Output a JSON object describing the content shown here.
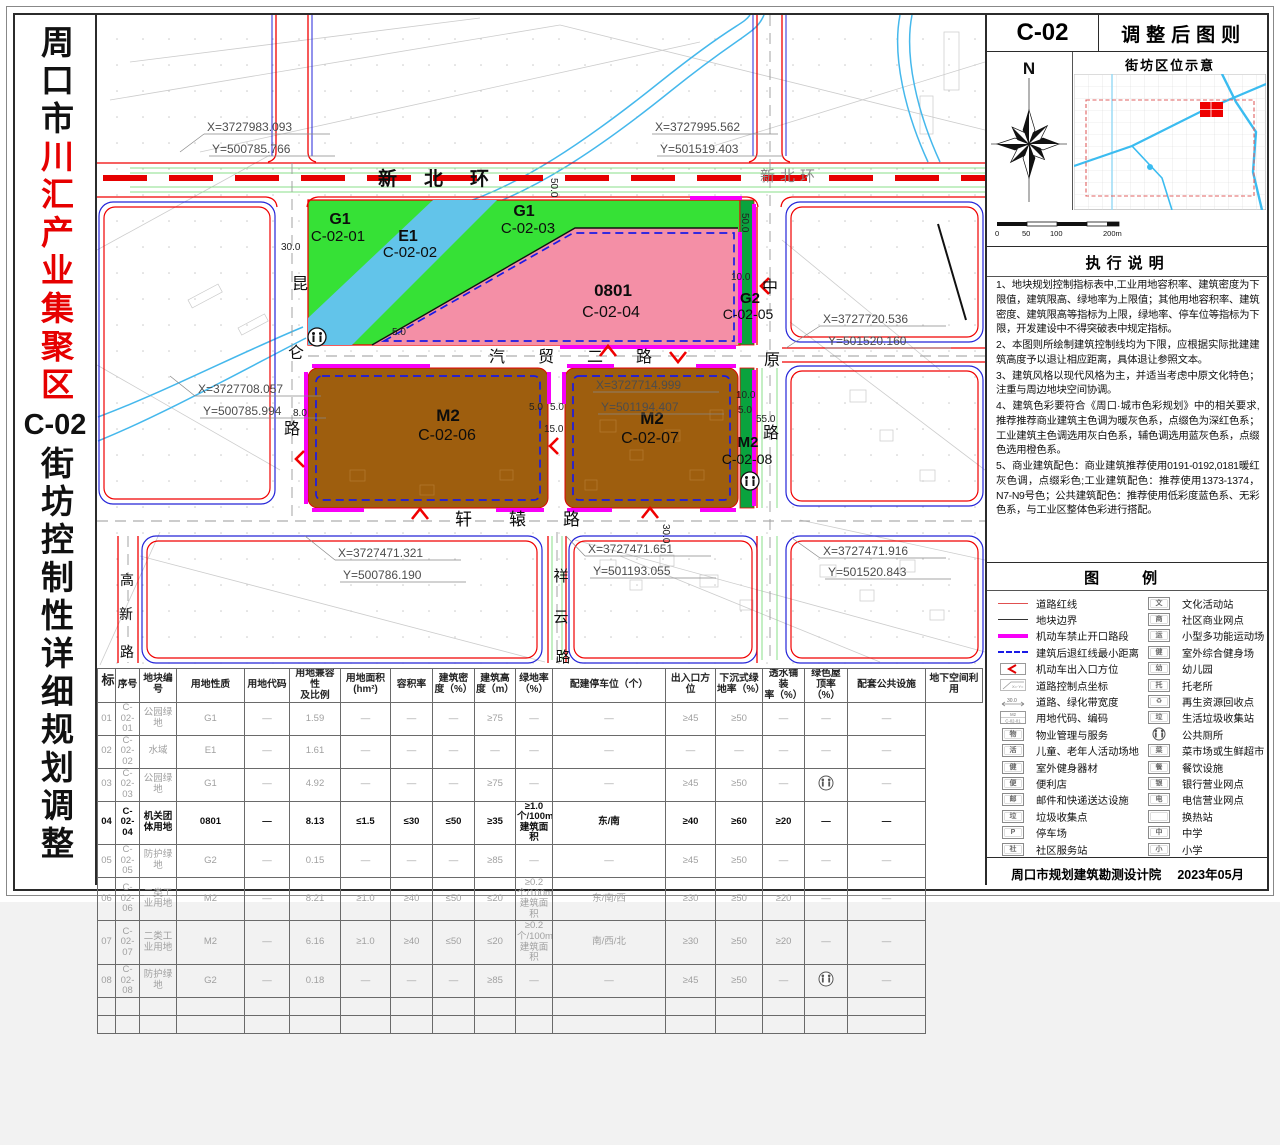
{
  "title": {
    "part1": "周口市",
    "highlight": "川汇产业集聚区",
    "code": "C-02",
    "part2": "街坊控制性详细规划调整"
  },
  "header": {
    "block_code": "C-02",
    "sheet_title": "调整后图则",
    "location_title": "街坊区位示意",
    "north_label": "N",
    "scale_labels": [
      "0",
      "50",
      "100",
      "200m"
    ]
  },
  "notes": {
    "title": "执行说明",
    "items": [
      "1、地块规划控制指标表中,工业用地容积率、建筑密度为下限值，建筑限高、绿地率为上限值；其他用地容积率、建筑密度、建筑限高等指标为上限，绿地率、停车位等指标为下限，开发建设中不得突破表中规定指标。",
      "2、本图则所绘制建筑控制线均为下限，应根据实际批建建筑高度予以退让相应距离，具体退让参照文本。",
      "3、建筑风格以现代风格为主，并适当考虑中原文化特色；注重与周边地块空间协调。",
      "4、建筑色彩要符合《周口·城市色彩规划》中的相关要求,推荐推荐商业建筑主色调为暖灰色系，点缀色为深红色系；工业建筑主色调选用灰白色系，辅色调选用蓝灰色系，点缀色选用橙色系。",
      "5、商业建筑配色：商业建筑推荐使用0191-0192,0181暖红灰色调，点缀彩色;工业建筑配色：推荐使用1373-1374，N7-N9号色；公共建筑配色：推荐使用低彩度蓝色系、无彩色系，与工业区整体色彩进行搭配。"
    ]
  },
  "legend": {
    "title": "图　例",
    "left": [
      {
        "sym": "line",
        "color": "#e05050",
        "label": "道路红线"
      },
      {
        "sym": "line",
        "color": "#333333",
        "label": "地块边界"
      },
      {
        "sym": "thick",
        "color": "#f800f8",
        "label": "机动车禁止开口路段"
      },
      {
        "sym": "dash",
        "color": "#1a1ae6",
        "label": "建筑后退红线最小距离"
      },
      {
        "sym": "arrow",
        "label": "机动车出入口方位"
      },
      {
        "sym": "coord",
        "symtext": "X=·Y=",
        "label": "道路控制点坐标"
      },
      {
        "sym": "width",
        "symtext": "30.0",
        "label": "道路、绿化带宽度"
      },
      {
        "sym": "code",
        "symtext": "M2|C-02-01",
        "label": "用地代码、编码"
      },
      {
        "sym": "box",
        "glyph": "物",
        "label": "物业管理与服务"
      },
      {
        "sym": "box",
        "glyph": "活",
        "label": "儿童、老年人活动场地"
      },
      {
        "sym": "box",
        "glyph": "健",
        "label": "室外健身器材"
      },
      {
        "sym": "box",
        "glyph": "便",
        "label": "便利店"
      },
      {
        "sym": "box",
        "glyph": "邮",
        "label": "邮件和快递送达设施"
      },
      {
        "sym": "box",
        "glyph": "垃",
        "label": "垃圾收集点"
      },
      {
        "sym": "box",
        "glyph": "P",
        "label": "停车场"
      },
      {
        "sym": "box",
        "glyph": "社",
        "label": "社区服务站"
      }
    ],
    "right": [
      {
        "sym": "box",
        "glyph": "文",
        "label": "文化活动站"
      },
      {
        "sym": "box",
        "glyph": "商",
        "label": "社区商业网点"
      },
      {
        "sym": "box",
        "glyph": "运",
        "label": "小型多功能运动场"
      },
      {
        "sym": "box",
        "glyph": "健",
        "label": "室外综合健身场"
      },
      {
        "sym": "box",
        "glyph": "幼",
        "label": "幼儿园"
      },
      {
        "sym": "box",
        "glyph": "托",
        "label": "托老所"
      },
      {
        "sym": "box",
        "glyph": "♻",
        "label": "再生资源回收点"
      },
      {
        "sym": "box",
        "glyph": "垃",
        "label": "生活垃圾收集站"
      },
      {
        "sym": "toilet",
        "label": "公共厕所"
      },
      {
        "sym": "box",
        "glyph": "菜",
        "label": "菜市场或生鲜超市"
      },
      {
        "sym": "box",
        "glyph": "餐",
        "label": "餐饮设施"
      },
      {
        "sym": "box",
        "glyph": "银",
        "label": "银行营业网点"
      },
      {
        "sym": "box",
        "glyph": "电",
        "label": "电信营业网点"
      },
      {
        "sym": "box",
        "glyph": "",
        "label": "换热站"
      },
      {
        "sym": "box",
        "glyph": "中",
        "label": "中学"
      },
      {
        "sym": "box",
        "glyph": "小",
        "label": "小学"
      }
    ]
  },
  "footer": {
    "org": "周口市规划建筑勘测设计院",
    "date": "2023年05月"
  },
  "map": {
    "road_names": {
      "xinbeihuan": "新北环",
      "xinbeihuan2": "新北环",
      "kunlun": "昆仑路",
      "zhongyuan": "中原路",
      "qimao": "汽贸二路",
      "xuanyuan": "轩辕路",
      "xiangyun": "祥云路",
      "gaoxin": "高新路"
    },
    "zones": [
      {
        "code": "G1",
        "id": "C-02-01"
      },
      {
        "code": "E1",
        "id": "C-02-02"
      },
      {
        "code": "G1",
        "id": "C-02-03"
      },
      {
        "code": "0801",
        "id": "C-02-04"
      },
      {
        "code": "G2",
        "id": "C-02-05"
      },
      {
        "code": "M2",
        "id": "C-02-06"
      },
      {
        "code": "M2",
        "id": "C-02-07"
      },
      {
        "code": "M2",
        "id": "C-02-08"
      }
    ],
    "coords": [
      {
        "x": "X=3727983.093",
        "y": "Y=500785.766"
      },
      {
        "x": "X=3727995.562",
        "y": "Y=501519.403"
      },
      {
        "x": "X=3727708.057",
        "y": "Y=500785.994"
      },
      {
        "x": "X=3727714.999",
        "y": "Y=501194.407"
      },
      {
        "x": "X=3727720.536",
        "y": "Y=501520.160"
      },
      {
        "x": "X=3727471.321",
        "y": "Y=500786.190"
      },
      {
        "x": "X=3727471.651",
        "y": "Y=501193.055"
      },
      {
        "x": "X=3727471.916",
        "y": "Y=501520.843"
      }
    ],
    "dims": [
      "50.0",
      "50.0",
      "30.0",
      "5.0",
      "8.0",
      "5.0",
      "5.0",
      "15.0",
      "10.0",
      "10.0",
      "5.0",
      "55.0",
      "30.0"
    ]
  },
  "table": {
    "row_header": "地块控制指标",
    "columns": [
      "序号",
      "地块编号",
      "用地性质",
      "用地代码",
      "用地兼容性\n及比例",
      "用地面积\n(hm²)",
      "容积率",
      "建筑密\n度（%）",
      "建筑高\n度（m）",
      "绿地率\n（%）",
      "配建停车位（个）",
      "出入口方位",
      "下沉式绿\n地率（%）",
      "透水铺装\n率（%）",
      "绿色屋\n顶率（%）",
      "配套公共设施",
      "地下空间利用"
    ],
    "rows": [
      {
        "muted": true,
        "cells": [
          "01",
          "C-02-01",
          "公园绿地",
          "G1",
          "—",
          "1.59",
          "—",
          "—",
          "—",
          "≥75",
          "—",
          "—",
          "≥45",
          "≥50",
          "—",
          "—",
          "—"
        ]
      },
      {
        "muted": true,
        "cells": [
          "02",
          "C-02-02",
          "水域",
          "E1",
          "—",
          "1.61",
          "—",
          "—",
          "—",
          "—",
          "—",
          "—",
          "—",
          "—",
          "—",
          "—",
          "—"
        ]
      },
      {
        "muted": true,
        "cells": [
          "03",
          "C-02-03",
          "公园绿地",
          "G1",
          "—",
          "4.92",
          "—",
          "—",
          "—",
          "≥75",
          "—",
          "—",
          "≥45",
          "≥50",
          "—",
          "toilet-icon",
          "—"
        ]
      },
      {
        "muted": false,
        "cells": [
          "04",
          "C-02-04",
          "机关团体用地",
          "0801",
          "—",
          "8.13",
          "≤1.5",
          "≤30",
          "≤50",
          "≥35",
          "≥1.0个/100m²建筑面积",
          "东/南",
          "≥40",
          "≥60",
          "≥20",
          "—",
          "—"
        ]
      },
      {
        "muted": true,
        "cells": [
          "05",
          "C-02-05",
          "防护绿地",
          "G2",
          "—",
          "0.15",
          "—",
          "—",
          "—",
          "≥85",
          "—",
          "—",
          "≥45",
          "≥50",
          "—",
          "—",
          "—"
        ]
      },
      {
        "muted": true,
        "cells": [
          "06",
          "C-02-06",
          "二类工业用地",
          "M2",
          "—",
          "8.21",
          "≥1.0",
          "≥40",
          "≤50",
          "≤20",
          "≥0.2个/100m²建筑面积",
          "东/南/西",
          "≥30",
          "≥50",
          "≥20",
          "—",
          "—"
        ]
      },
      {
        "muted": true,
        "cells": [
          "07",
          "C-02-07",
          "二类工业用地",
          "M2",
          "—",
          "6.16",
          "≥1.0",
          "≥40",
          "≤50",
          "≤20",
          "≥0.2个/100m²建筑面积",
          "南/西/北",
          "≥30",
          "≥50",
          "≥20",
          "—",
          "—"
        ]
      },
      {
        "muted": true,
        "cells": [
          "08",
          "C-02-08",
          "防护绿地",
          "G2",
          "—",
          "0.18",
          "—",
          "—",
          "—",
          "≥85",
          "—",
          "—",
          "≥45",
          "≥50",
          "—",
          "toilet-icon",
          "—"
        ]
      },
      {
        "muted": true,
        "cells": [
          "",
          "",
          "",
          "",
          "",
          "",
          "",
          "",
          "",
          "",
          "",
          "",
          "",
          "",
          "",
          "",
          ""
        ]
      },
      {
        "muted": true,
        "cells": [
          "",
          "",
          "",
          "",
          "",
          "",
          "",
          "",
          "",
          "",
          "",
          "",
          "",
          "",
          "",
          "",
          ""
        ]
      }
    ]
  },
  "colors": {
    "g1_green": "#36e136",
    "g2_green": "#0aa33e",
    "e1_water": "#62c4ea",
    "m2_brown": "#9e5e0e",
    "c0801_pink": "#f48fa6",
    "no_opening_magenta": "#f800f8",
    "setback_blue": "#1a1ae6",
    "road_red": "#f00000",
    "title_red": "#e60000"
  }
}
